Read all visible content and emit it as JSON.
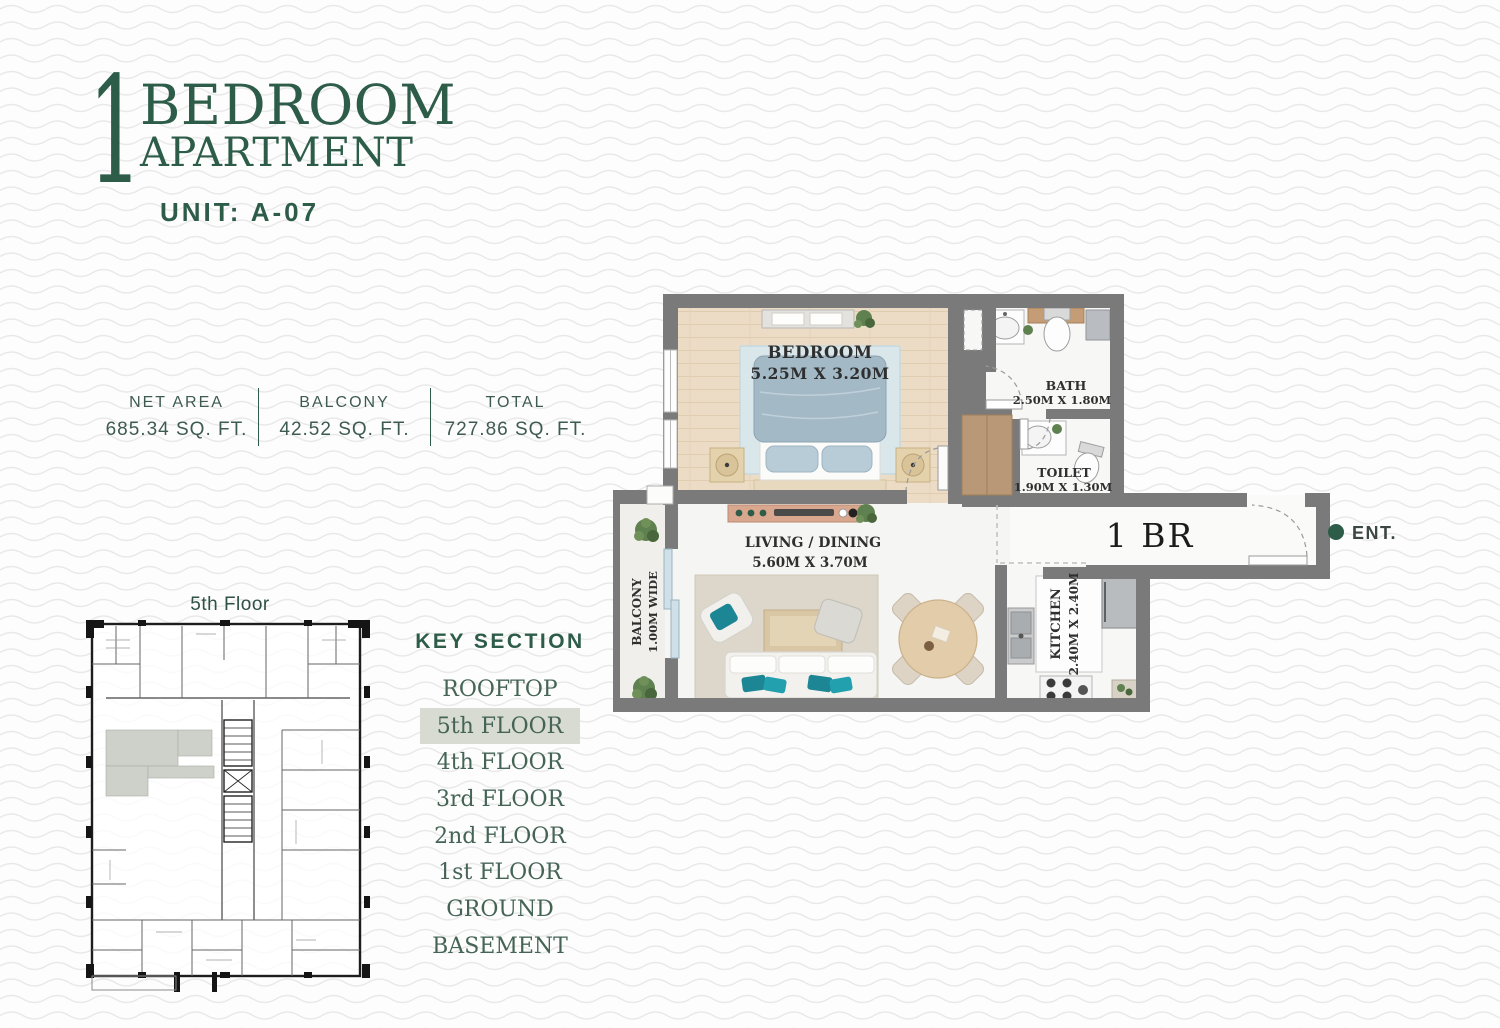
{
  "header": {
    "big_number": "1",
    "title_line1": "BEDROOM",
    "title_line2": "APARTMENT",
    "unit": "UNIT: A-07"
  },
  "stats": {
    "items": [
      {
        "label": "NET AREA",
        "value": "685.34 SQ. FT."
      },
      {
        "label": "BALCONY",
        "value": "42.52 SQ. FT."
      },
      {
        "label": "TOTAL",
        "value": "727.86 SQ. FT."
      }
    ]
  },
  "plan": {
    "bedroom_name": "BEDROOM",
    "bedroom_dims": "5.25M X 3.20M",
    "bath_name": "BATH",
    "bath_dims": "2.50M X 1.80M",
    "toilet_name": "TOILET",
    "toilet_dims": "1.90M X 1.30M",
    "living_name": "LIVING / DINING",
    "living_dims": "5.60M X 3.70M",
    "kitchen_name": "KITCHEN",
    "kitchen_dims": "2.40M X 2.40M",
    "balcony_name": "BALCONY",
    "balcony_dims": "1.00M WIDE",
    "unit_label": "1 BR",
    "entrance_label": "ENT."
  },
  "key_plan": {
    "caption": "5th Floor"
  },
  "key_section": {
    "heading": "KEY SECTION",
    "items": [
      {
        "label": "ROOFTOP",
        "active": false
      },
      {
        "label": "5th FLOOR",
        "active": true
      },
      {
        "label": "4th FLOOR",
        "active": false
      },
      {
        "label": "3rd FLOOR",
        "active": false
      },
      {
        "label": "2nd FLOOR",
        "active": false
      },
      {
        "label": "1st FLOOR",
        "active": false
      },
      {
        "label": "GROUND",
        "active": false
      },
      {
        "label": "BASEMENT",
        "active": false
      }
    ]
  },
  "colors": {
    "accent_green": "#2d5c49",
    "stats_text": "#3e5b52",
    "highlight_row_bg": "#d7dbd2",
    "wall_gray": "#7a7a7a",
    "entrance_dot": "#2d5c49"
  }
}
